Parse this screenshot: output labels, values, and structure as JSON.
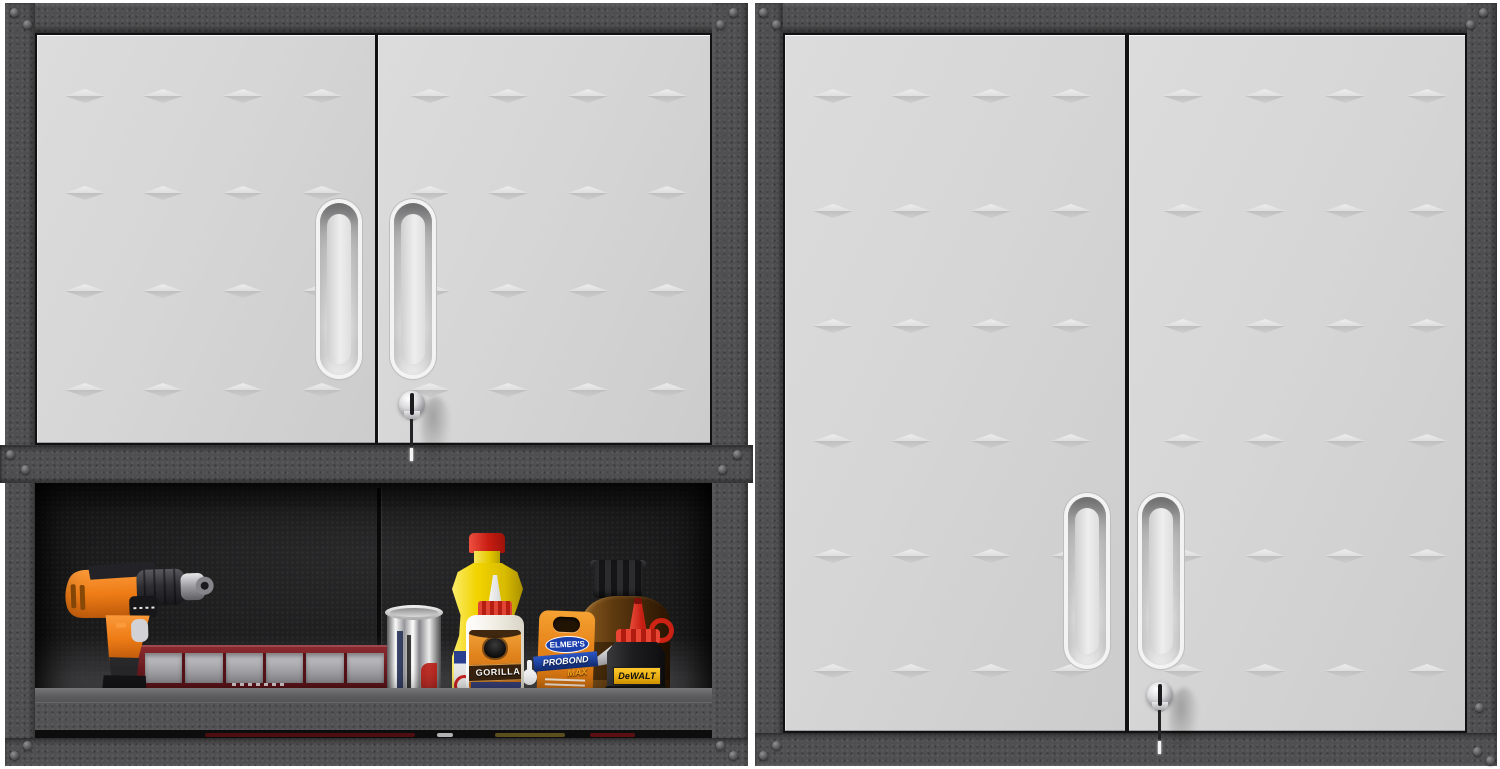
{
  "image": {
    "kind": "product-photo",
    "subject": "Two metal garage wall-mounted storage cabinets",
    "background": "#ffffff"
  },
  "colors": {
    "frame": "#4f4f51",
    "door": "#d6d6d6",
    "interior": "#1a1a1b",
    "shelf_lip": "#5c5c5e"
  },
  "left_cabinet": {
    "name": "wall-cabinet-with-open-bottom-shelf",
    "doors": 2,
    "emboss_grid": {
      "rows": 4,
      "cols": 4
    },
    "handles": 2,
    "lock": {
      "style": "chrome-cam-lock",
      "key_inserted": true
    },
    "shelf_items": [
      {
        "name": "cordless-drill",
        "primary_color": "#f07d1e"
      },
      {
        "name": "parts-organizer-bin",
        "primary_color": "#6e1d22"
      },
      {
        "name": "chrome-canister",
        "primary_color": "#c9c9c9"
      },
      {
        "name": "yellow-glue-bottle",
        "primary_color": "#f2d400",
        "cap_color": "#c81d12"
      },
      {
        "name": "gorilla-glue-bottle",
        "brand": "GORILLA",
        "primary_color": "#f3f0e7",
        "label_color": "#e0821c"
      },
      {
        "name": "elmers-probond-package",
        "brand": "ELMER'S",
        "product": "PROBOND",
        "variant": "MAX",
        "primary_color": "#e8861c"
      },
      {
        "name": "amber-bottle",
        "primary_color": "#5f3a10"
      },
      {
        "name": "dewalt-chalk-bottle",
        "brand": "DeWALT",
        "primary_color": "#1d1d1f",
        "cap_color": "#cf2315",
        "label_color": "#f0a900"
      }
    ]
  },
  "right_cabinet": {
    "name": "wall-cabinet-closed",
    "doors": 2,
    "emboss_grid": {
      "rows": 6,
      "cols": 4
    },
    "handles": 2,
    "lock": {
      "style": "chrome-cam-lock",
      "key_inserted": true
    }
  }
}
